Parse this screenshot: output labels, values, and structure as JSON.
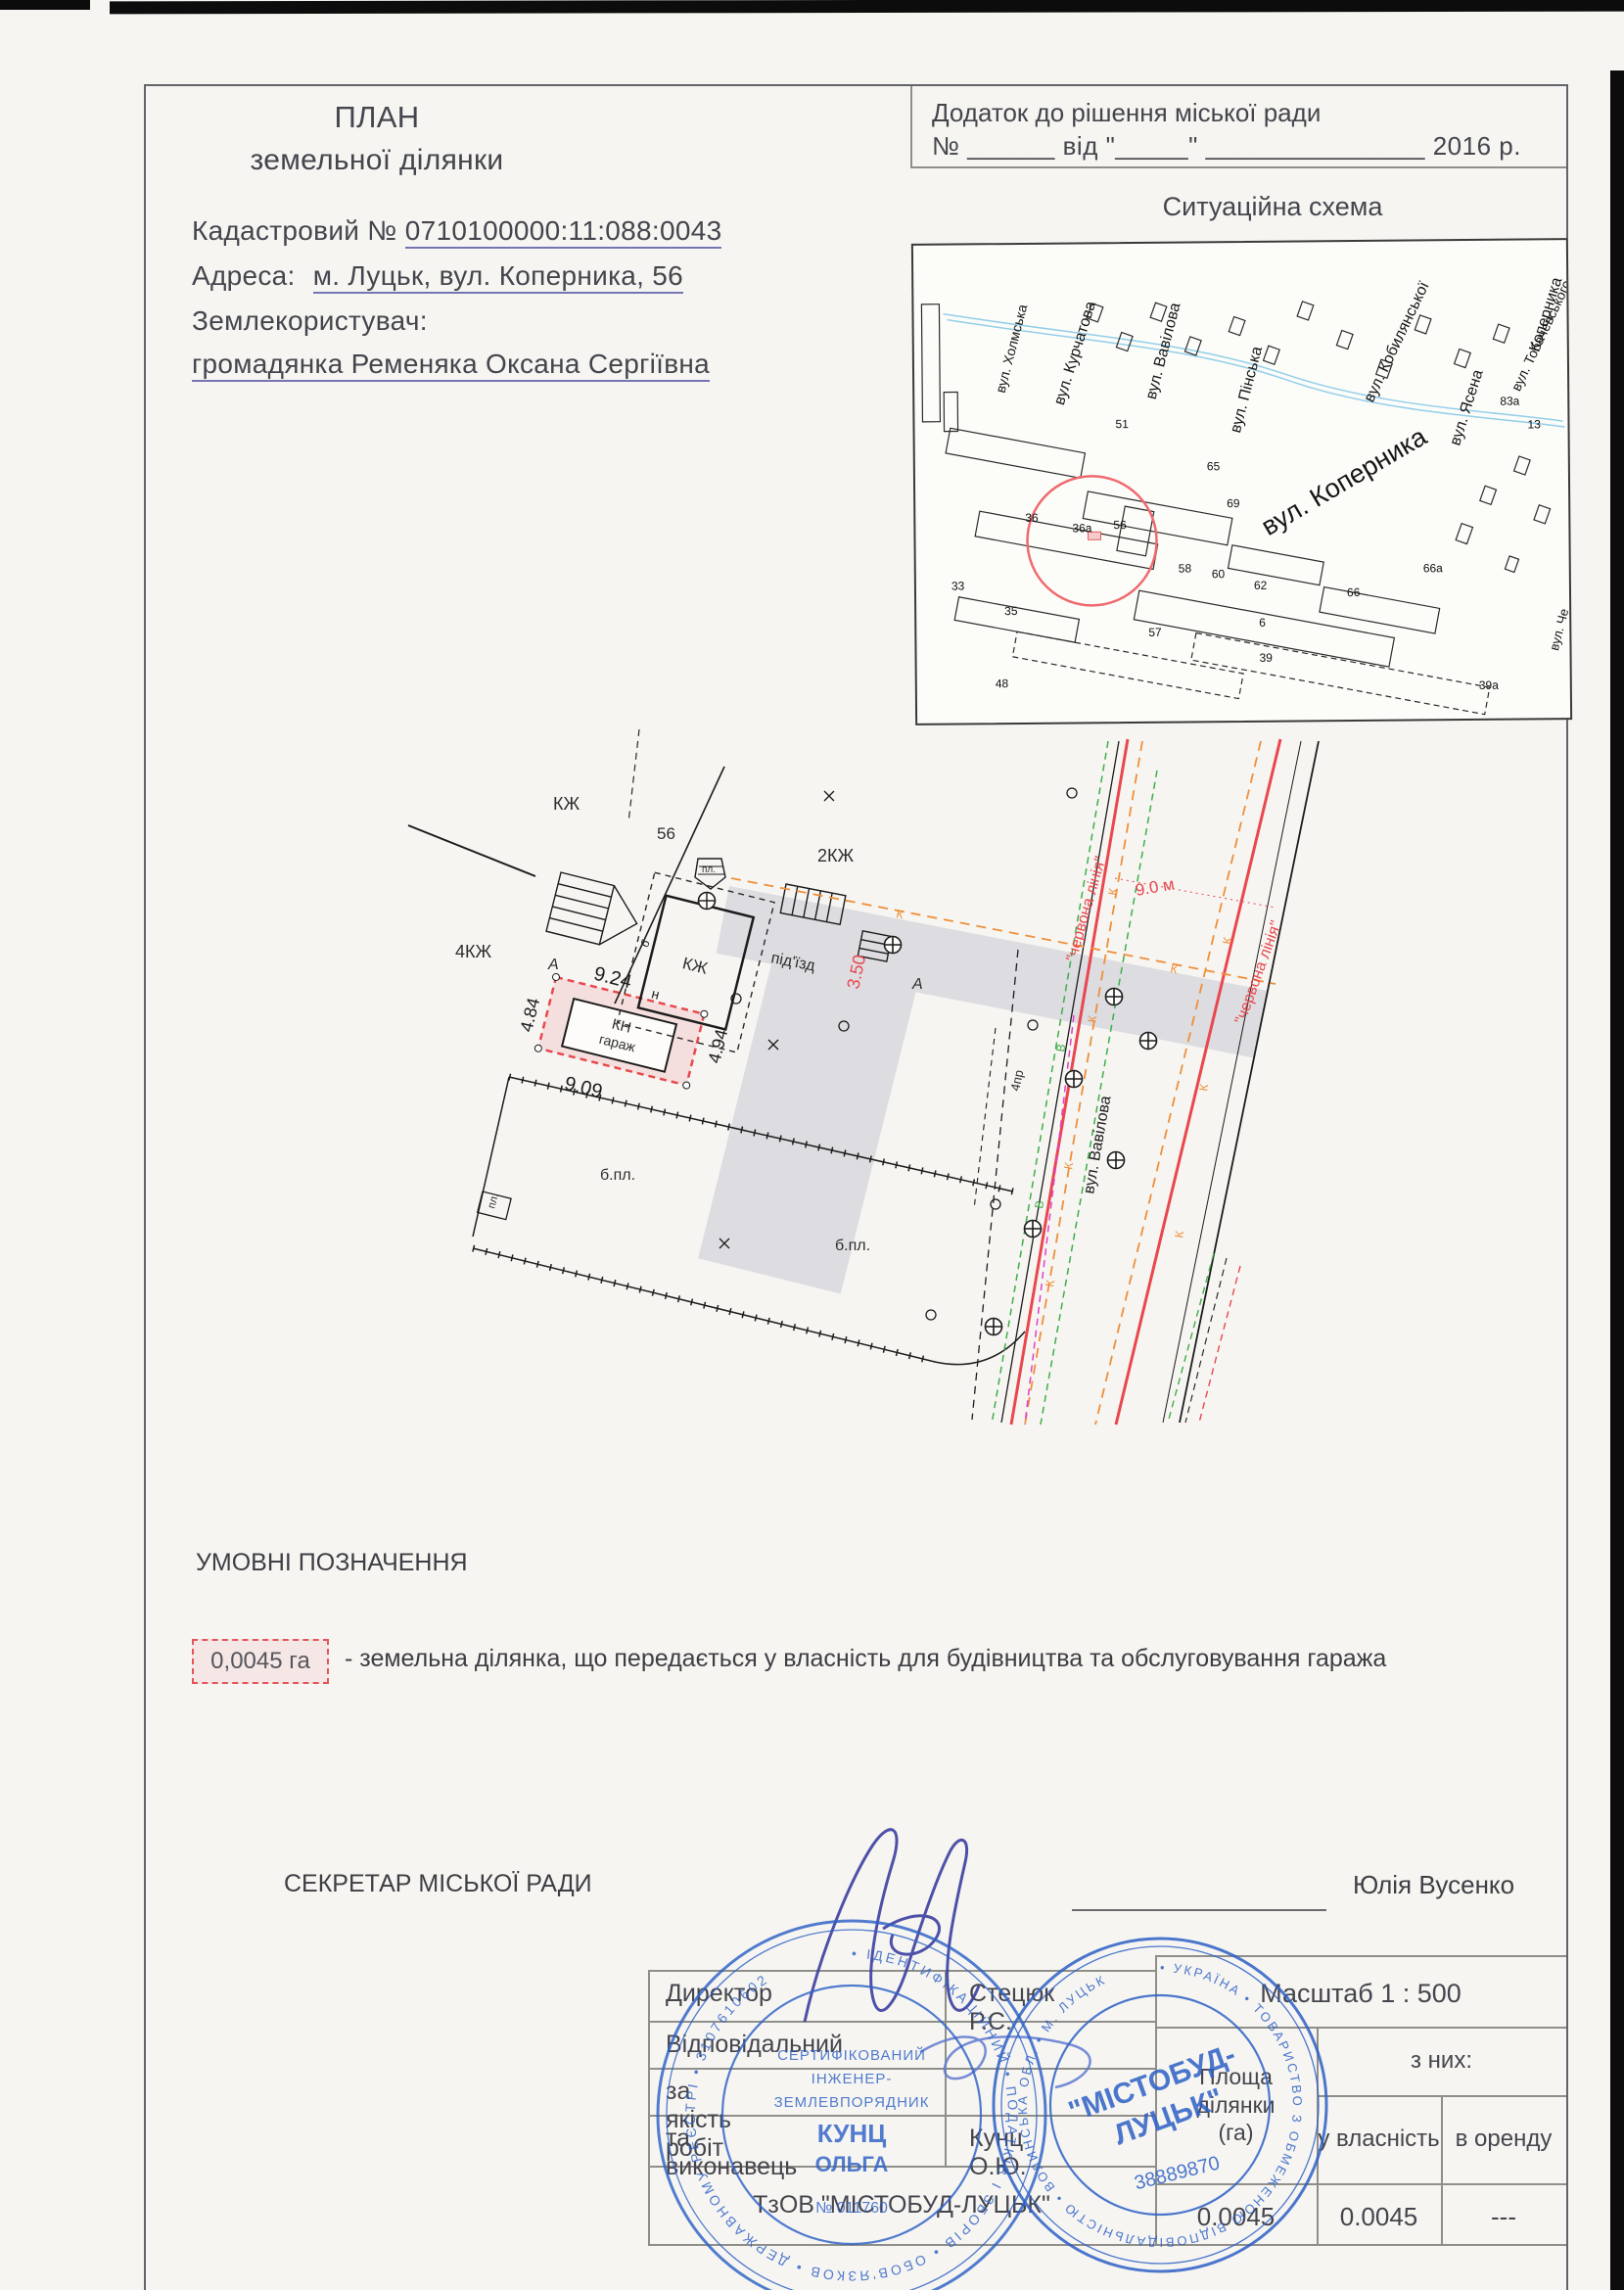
{
  "colors": {
    "paper": "#f6f5f2",
    "ink": "#45454d",
    "red_line": "#e8484e",
    "comm_orange": "#ef8f3a",
    "comm_green": "#3fae49",
    "comm_magenta": "#e040c8",
    "driveway_gray": "#dcdce1",
    "stamp_blue": "#2e61c6"
  },
  "header": {
    "title_line1": "ПЛАН",
    "title_line2": "земельної ділянки",
    "cadastral_label": "Кадастровий №",
    "cadastral_number": "0710100000:11:088:0043",
    "address_label": "Адреса:",
    "address_value": "м. Луцьк, вул. Коперника, 56",
    "landuser_label": "Землекористувач:",
    "landuser_value": "громадянка Ременяка Оксана Сергіївна"
  },
  "annex": {
    "line1": "Додаток до рішення міської ради",
    "line2": "№ ______ від \"_____\" _______________ 2016 р."
  },
  "map": {
    "title": "Ситуаційна схема",
    "streets": [
      "вул. Вавілова",
      "вул. Пінська",
      "вул. Кобилянської",
      "вул. Ясена",
      "вул. Тобачевського",
      "вул. Коперника",
      "вул. Курчатова",
      "вул. Холмська",
      "Коперника",
      "вул. Че"
    ],
    "numbers": [
      "56",
      "36а",
      "36",
      "33",
      "35",
      "57",
      "48",
      "58",
      "60",
      "62",
      "66",
      "39",
      "65",
      "69",
      "51",
      "83а",
      "13",
      "6",
      "39а",
      "66а"
    ]
  },
  "plan": {
    "labels": {
      "kzh_a": "КЖ",
      "kzh_b": "КЖ",
      "kzh2": "2КЖ",
      "kzh4": "4КЖ",
      "n56": "56",
      "b": "б",
      "pl": "пл.",
      "pl2": "пл.",
      "a": "А",
      "n": "н",
      "kn": "КН",
      "garage": "гараж",
      "d924": "9.24",
      "d484": "4.84",
      "d909": "9.09",
      "d494": "4.94",
      "driveway": "під'їзд",
      "d350": "3.50",
      "bpl": "б.пл.",
      "pr4": "4пр",
      "street": "вул. Вавілова",
      "redline": "\"червона лінія\"",
      "reddim": "9.0 м",
      "k": "К",
      "v": "В"
    }
  },
  "legend": {
    "title": "УМОВНІ ПОЗНАЧЕННЯ",
    "area_value": "0,0045 га",
    "description": "- земельна ділянка, що передається у власність для будівництва та обслуговування гаража"
  },
  "secretary": {
    "label": "СЕКРЕТАР МІСЬКОЇ РАДИ",
    "name": "Юлія Вусенко"
  },
  "table": {
    "rows": [
      {
        "label": "Директор",
        "value": "Стецюк Р.С."
      },
      {
        "label": "Відповідальний",
        "value": ""
      },
      {
        "label": "за якість робіт",
        "value": ""
      },
      {
        "label": "та виконавець",
        "value": "Кунц О.Ю."
      }
    ],
    "company": "ТзОВ \"МІСТОБУД-ЛУЦЬК\"",
    "scale": "Масштаб 1 : 500",
    "area_header": "Площа\nділянки\n(га)",
    "of_them": "з них:",
    "ownership": "у власність",
    "lease": "в оренду",
    "v_total": "0.0045",
    "v_own": "0.0045",
    "v_lease": "---"
  },
  "stamps": {
    "engineer": {
      "ring": "• ІДЕНТИФІКАЦІЙНИЙ • ПОДАТКІВ І ЗБОРІВ • ОБОВ'ЯЗКОВ • ДЕРЖАВНОМУ РЕЄСТРІ • 3107610602 ",
      "line1": "СЕРТИФІКОВАНИЙ",
      "line2": "ІНЖЕНЕР-",
      "line3": "ЗЕМЛЕВПОРЯДНИК",
      "name1": "КУНЦ",
      "name2": "ОЛЬГА",
      "number": "№ 011760"
    },
    "company": {
      "ring": "• УКРАЇНА • ТОВАРИСТВО З ОБМЕЖЕНОЮ ВІДПОВІДАЛЬНІСТЮ • ВОЛИНСЬКА ОБЛ. • М. ЛУЦЬК ",
      "big1": "\"МІСТОБУД-",
      "big2": "ЛУЦЬК\"",
      "code": "38889870"
    }
  }
}
